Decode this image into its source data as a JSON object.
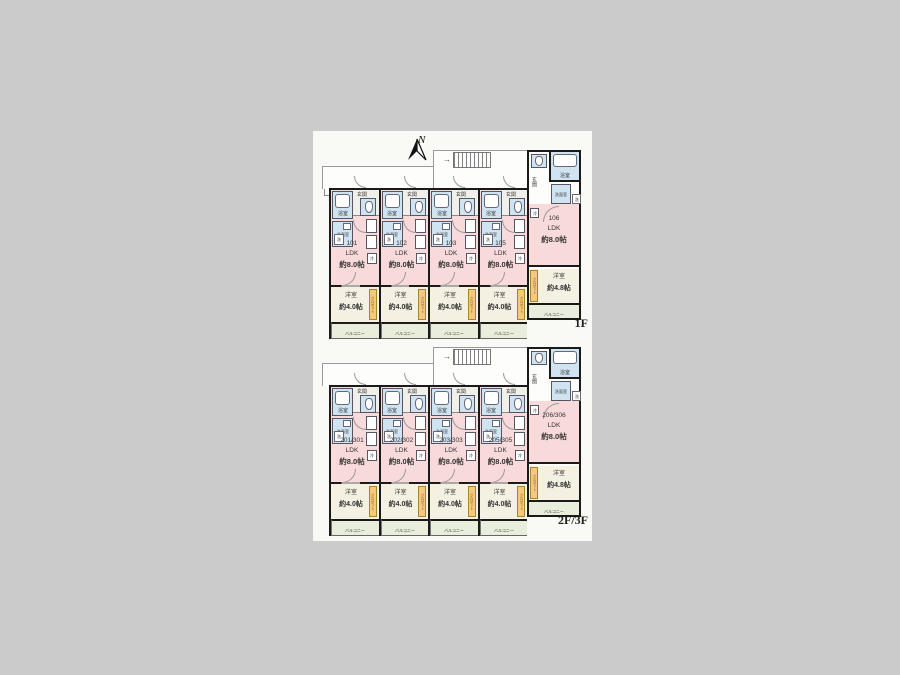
{
  "colors": {
    "canvas_bg": "#cbcbcb",
    "sheet_bg": "#f9f9f6",
    "wall": "#1a1a1a",
    "ldk": "#f8dada",
    "bedroom": "#f4f0e2",
    "balcony": "#e9eddb",
    "sanitary": "#cfe3f1",
    "closet": "#f5c97c",
    "hall": "#f1efe9"
  },
  "labels": {
    "north": "N",
    "bath": "浴室",
    "entrance": "玄関",
    "washroom": "洗面室",
    "washer": "洗",
    "fridge": "冷",
    "ldk": "LDK",
    "bedroom": "洋室",
    "balcony": "バルコニー",
    "closet": "クロゼット",
    "stairs_arrow": "→"
  },
  "floors": [
    {
      "label": "1F",
      "units": [
        {
          "no": "101",
          "ldk_size": "約8.0帖",
          "bedroom_size": "約4.0帖"
        },
        {
          "no": "102",
          "ldk_size": "約8.0帖",
          "bedroom_size": "約4.0帖"
        },
        {
          "no": "103",
          "ldk_size": "約8.0帖",
          "bedroom_size": "約4.0帖"
        },
        {
          "no": "105",
          "ldk_size": "約8.0帖",
          "bedroom_size": "約4.0帖"
        }
      ],
      "corner": {
        "no": "106",
        "ldk_size": "約8.0帖",
        "bedroom_size": "約4.8帖"
      }
    },
    {
      "label": "2F/3F",
      "units": [
        {
          "no": "201/301",
          "ldk_size": "約8.0帖",
          "bedroom_size": "約4.0帖"
        },
        {
          "no": "202/302",
          "ldk_size": "約8.0帖",
          "bedroom_size": "約4.0帖"
        },
        {
          "no": "203/303",
          "ldk_size": "約8.0帖",
          "bedroom_size": "約4.0帖"
        },
        {
          "no": "205/305",
          "ldk_size": "約8.0帖",
          "bedroom_size": "約4.0帖"
        }
      ],
      "corner": {
        "no": "206/306",
        "ldk_size": "約8.0帖",
        "bedroom_size": "約4.8帖"
      }
    }
  ]
}
